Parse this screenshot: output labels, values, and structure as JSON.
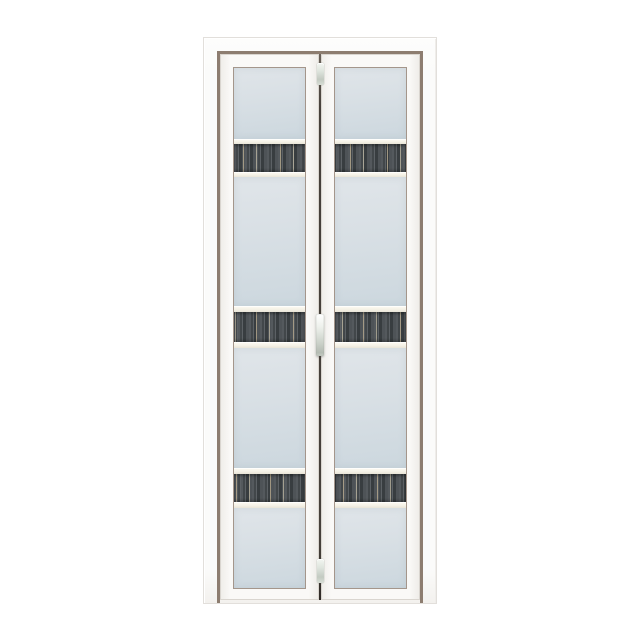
{
  "meta": {
    "description": "Product photo of a white aluminium bi-fold bathroom door with frosted glass panels and dark wood-grain accent bands, centered on a plain white background",
    "visible_text": []
  },
  "door": {
    "style": "bi-fold",
    "panel_count": 2,
    "accent_bands_per_panel": 3,
    "glass": "frosted light blue-grey",
    "band_pattern": "dark vertical wood-grain strip framed by cream trim rails",
    "hardware": [
      {
        "name": "top-pivot-hinge",
        "finish": "silver"
      },
      {
        "name": "center-pull-handle",
        "finish": "silver"
      },
      {
        "name": "bottom-pivot-hinge",
        "finish": "silver"
      }
    ]
  },
  "colors": {
    "background": "#ffffff",
    "frame-white": "#fbfbfa",
    "frame-edge": "#e2dfdb",
    "frame-reveal": "#8d7d70",
    "panel-white": "#faf9f7",
    "glazing-line": "#a4968b",
    "glass-top": "#d9e0e5",
    "glass-bottom": "#ccd7de",
    "band-cream": "#f5f2e7",
    "strip-dark": "#4a4f53",
    "strip-streak": "#b2a68c",
    "hinge-silver": "#dfe5de",
    "center-gap": "#46403a"
  }
}
